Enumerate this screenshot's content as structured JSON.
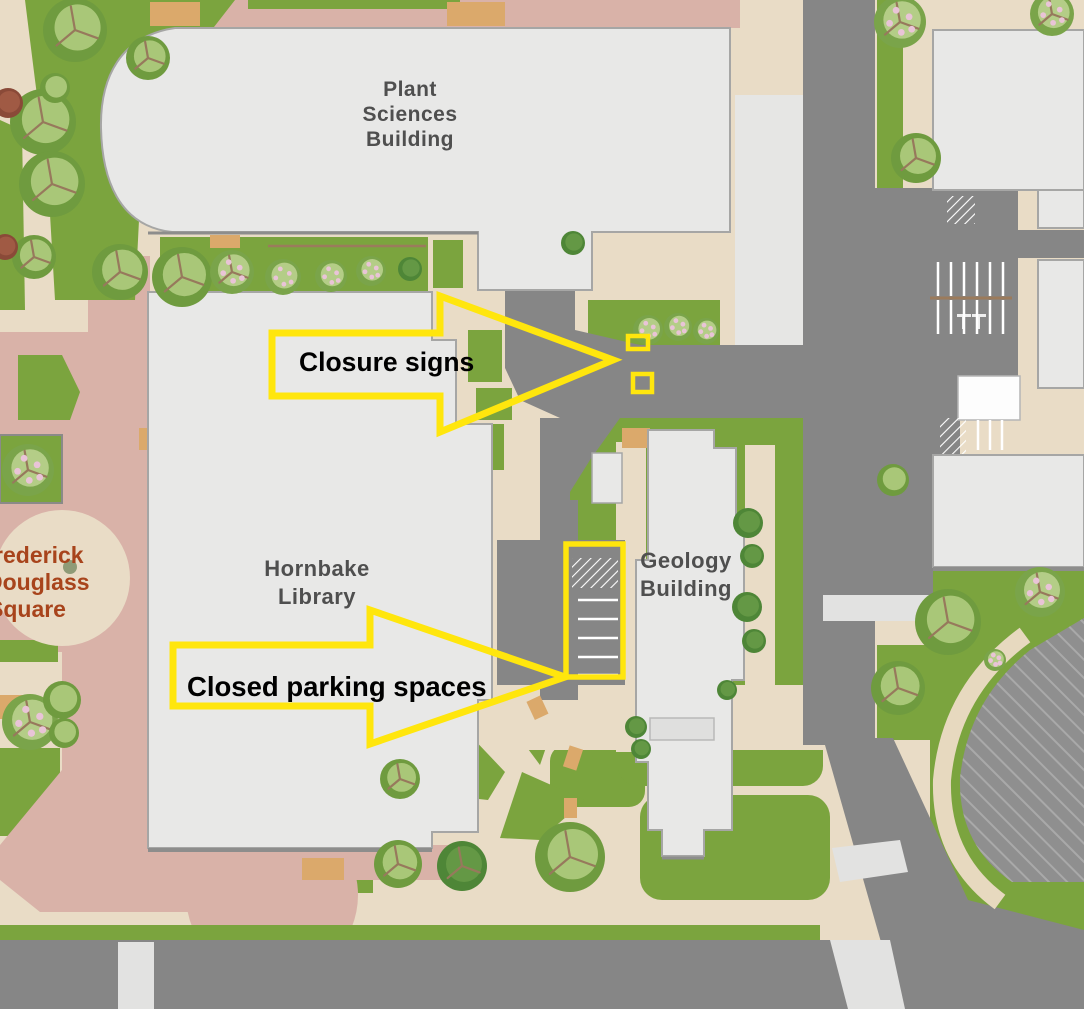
{
  "page": {
    "type": "annotated-campus-map"
  },
  "buildings": {
    "plant_sciences": [
      "Plant",
      "Sciences",
      "Building"
    ],
    "hornbake": [
      "Hornbake",
      "Library"
    ],
    "geology": [
      "Geology",
      "Building"
    ],
    "douglass_square": [
      "Frederick",
      "Douglass",
      "Square"
    ]
  },
  "annotations": {
    "closure_signs": {
      "label": "Closure signs"
    },
    "closed_parking": {
      "label": "Closed parking spaces"
    }
  },
  "colors": {
    "building_fill": "#e8e8e7",
    "building_stroke": "#a6a6a5",
    "road": "#868686",
    "crosswalk": "#e2e2e1",
    "lawn": "#7ba43e",
    "path_tan": "#e9dcc6",
    "accent_orange": "#dba96b",
    "plaza_pink": "#d9b2a8",
    "highlight_yellow": "#ffe60d",
    "label_gray": "#4f4f4f",
    "douglass_rust": "#a8441c"
  }
}
